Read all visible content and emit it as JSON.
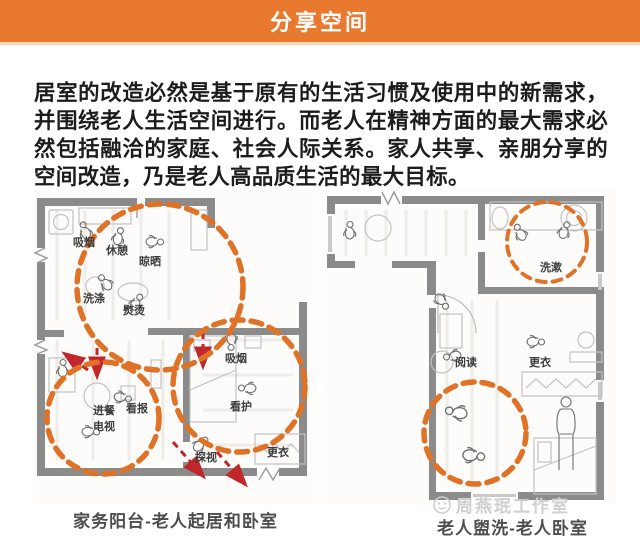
{
  "header": {
    "title": "分享空间"
  },
  "intro": "居室的改造必然是基于原有的生活习惯及使用中的新需求，并围绕老人生活空间进行。而老人在精神方面的最大需求必然包括融洽的家庭、社会人际关系。家人共享、亲朋分享的空间改造，乃是老人高品质生活的最大目标。",
  "plans": {
    "left": {
      "caption": "家务阳台-老人起居和卧室",
      "labels": {
        "smoking_balcony": "吸烟",
        "rest": "休憩",
        "drying": "晾晒",
        "laundry": "洗涤",
        "ironing": "熨烫",
        "dining": "进餐",
        "newspaper": "看报",
        "tv": "电视",
        "smoking_bedroom": "吸烟",
        "caregiving": "看护",
        "visiting": "探视",
        "dressing": "更衣"
      }
    },
    "right": {
      "caption": "老人盥洗-老人卧室",
      "labels": {
        "washing": "洗漱",
        "reading": "阅读",
        "dressing": "更衣"
      }
    }
  },
  "watermark": "周燕珉工作室",
  "colors": {
    "banner": "#E8792E",
    "activity_circle": "#DF7226",
    "flow_arrow": "#C0272B",
    "wall": "#8B8B8B",
    "caption": "#4D4D4D"
  }
}
